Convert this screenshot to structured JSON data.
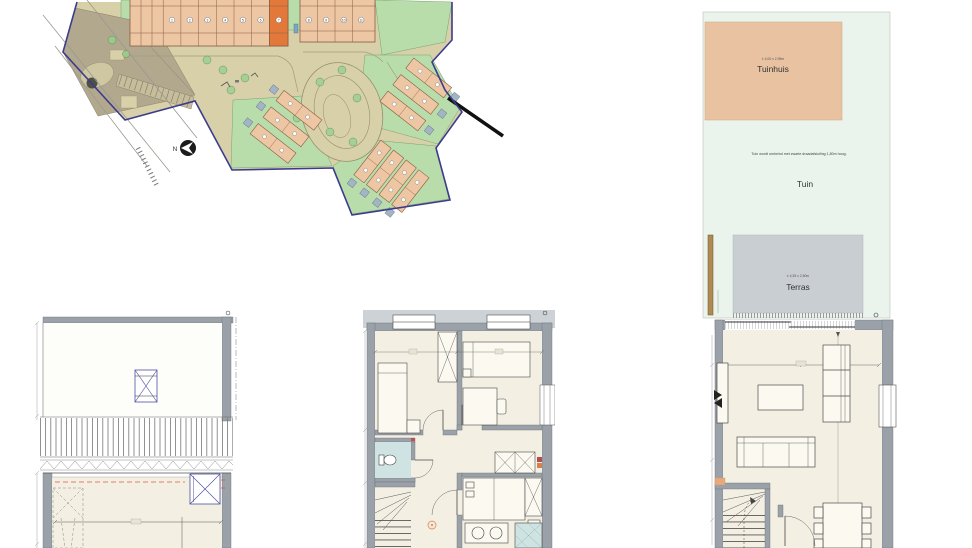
{
  "site_plan": {
    "north_label": "N",
    "row_a_units": [
      "1",
      "2",
      "3",
      "4",
      "5",
      "6",
      "7"
    ],
    "row_b_units": [
      "8",
      "9",
      "10",
      "11"
    ],
    "highlighted_unit": "7",
    "colors": {
      "road": "#d8d0a8",
      "house": "#edc6a4",
      "highlight": "#e2793b",
      "green": "#b9dcab",
      "shed": "#a3b4c4",
      "parking": "#b1a88e",
      "boundary": "#3c3c8e"
    }
  },
  "garden_plan": {
    "tuinhuis_label": "Tuinhuis",
    "tuinhuis_dimension": "± 4,00 x 2,95m",
    "fence_note": "Tuin wordt omheind met zwarte draadafsluiting 1,80m hoog.",
    "tuin_label": "Tuin",
    "terras_label": "Terras",
    "terras_dimension": "± 4,35 x 2,50m",
    "colors": {
      "garden": "#eaf3ec",
      "tuinhuis": "#e9c2a2",
      "terras": "#c9ced2",
      "fence": "#b08a54"
    }
  },
  "floor_plans": {
    "colors": {
      "wall": "#9aa1a8",
      "room": "#f3f0e3",
      "bathroom": "#cfe4e2",
      "accent_purple": "#4d4da0",
      "accent_red": "#e05544",
      "accent_orange": "#d4824a"
    }
  }
}
